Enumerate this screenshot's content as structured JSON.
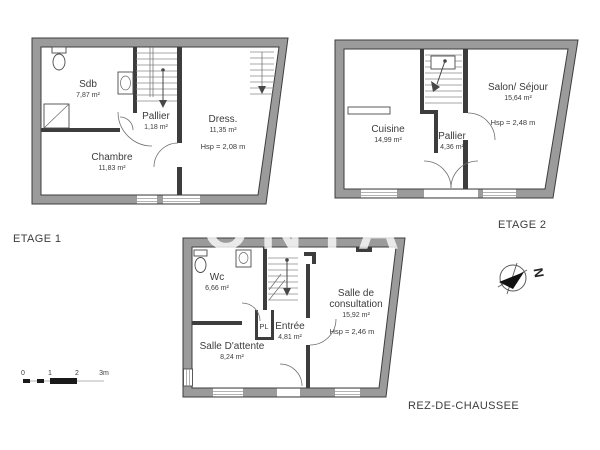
{
  "floors": {
    "etage1": {
      "label": "ETAGE 1",
      "rooms": {
        "sdb": {
          "name": "Sdb",
          "area": "7,87 m²"
        },
        "pallier": {
          "name": "Pallier",
          "area": "1,18 m²"
        },
        "dress": {
          "name": "Dress.",
          "area": "11,35 m²",
          "ceiling": "Hsp = 2,08 m"
        },
        "chambre": {
          "name": "Chambre",
          "area": "11,83 m²"
        }
      }
    },
    "etage2": {
      "label": "ETAGE 2",
      "rooms": {
        "cuisine": {
          "name": "Cuisine",
          "area": "14,99 m²"
        },
        "pallier": {
          "name": "Pallier",
          "area": "4,36 m²"
        },
        "salon": {
          "name": "Salon/ Séjour",
          "area": "15,64 m²",
          "ceiling": "Hsp = 2,48 m"
        }
      }
    },
    "rdc": {
      "label": "REZ-DE-CHAUSSEE",
      "rooms": {
        "wc": {
          "name": "Wc",
          "area": "6,66 m²"
        },
        "pl": {
          "name": "PL"
        },
        "entree": {
          "name": "Entrée",
          "area": "4,81 m²"
        },
        "attente": {
          "name": "Salle D'attente",
          "area": "8,24 m²"
        },
        "consultation": {
          "name_line1": "Salle de",
          "name_line2": "consultation",
          "area": "15,92 m²",
          "ceiling": "Hsp = 2,46 m"
        }
      }
    }
  },
  "scale_bar": {
    "ticks": [
      "0",
      "1",
      "2",
      "3m"
    ]
  },
  "compass": {
    "north_label": "N"
  },
  "watermark": "FONTA",
  "colors": {
    "wall": "#9b9b9b",
    "wall_outline": "#3d3d3d",
    "text": "#3c3c3c"
  }
}
